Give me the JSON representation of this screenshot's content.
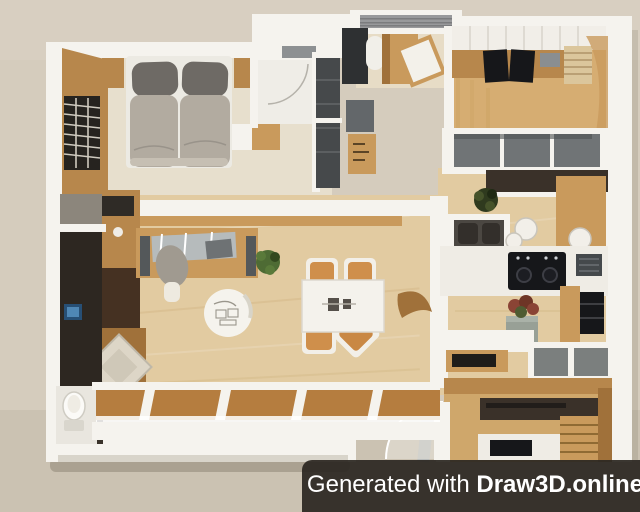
{
  "watermark": {
    "prefix": "Generated with ",
    "brand": "Draw3D.online"
  },
  "colors": {
    "background": "#d5ccbd",
    "wall": "#f5f3ee",
    "wall_shadow": "#d8d4ca",
    "wood_light": "#c99a5c",
    "wood_mid": "#b7874c",
    "wood_dark": "#a0713a",
    "carpet": "#e7dfcd",
    "floor_living": "#e2cba1",
    "floor_study": "#d6ad72",
    "floor_den": "#cfa76b",
    "charcoal": "#46494b",
    "dark_brown": "#3a3129",
    "near_black": "#16171a",
    "gray_panel": "#707476",
    "duvet": "#b2aba0",
    "pillow": "#6e6a65",
    "cushion": "#ddd6c7",
    "glass": "#b3c1cc",
    "plant_green": "#4e6b34",
    "plant_rust": "#8a4435",
    "stool_white": "#f2efe9",
    "window_pane": "#b57d3f",
    "blind_gray": "#98999b",
    "utility_dark": "#2d2721",
    "watermark_bg": "rgba(43,39,33,0.93)",
    "watermark_text": "#ffffff"
  },
  "floor_plan": {
    "type": "3d-rendered-top-down-apartment",
    "rooms": [
      {
        "name": "bedroom",
        "furniture": [
          "double-bed",
          "gray-pillows",
          "nightstands",
          "slatted-window",
          "wood-panel-wall"
        ]
      },
      {
        "name": "walk-in-closet",
        "furniture": [
          "charcoal-shelving",
          "storage-box",
          "gray-shelf"
        ]
      },
      {
        "name": "top-storage-room",
        "furniture": [
          "gray-blinds",
          "wood-cabinet",
          "tilted-panel"
        ]
      },
      {
        "name": "study",
        "furniture": [
          "upper-cabinets",
          "desk",
          "black-monitors",
          "ladder-shelf"
        ]
      },
      {
        "name": "living-room",
        "furniture": [
          "work-desk",
          "office-chair",
          "round-coffee-table",
          "corner-bench",
          "beige-cushion",
          "tv-cabinet",
          "green-plant",
          "wood-decor"
        ]
      },
      {
        "name": "dining-area",
        "furniture": [
          "white-dining-table",
          "four-tan-chairs"
        ]
      },
      {
        "name": "kitchen",
        "furniture": [
          "gray-sideboard",
          "dark-counter",
          "wood-bar",
          "bar-stools",
          "island-sink",
          "cooktop",
          "microwave",
          "fridge",
          "potted-plant",
          "tv-shelf",
          "gray-cabinet"
        ]
      },
      {
        "name": "utility-room",
        "furniture": [
          "blue-panel-device"
        ]
      },
      {
        "name": "toilet-room",
        "furniture": [
          "toilet"
        ]
      },
      {
        "name": "den",
        "furniture": [
          "media-console",
          "work-table",
          "stairs",
          "glass-door"
        ]
      },
      {
        "name": "south-wall",
        "furniture": [
          "window-row",
          "entry-door-arc"
        ]
      }
    ]
  }
}
